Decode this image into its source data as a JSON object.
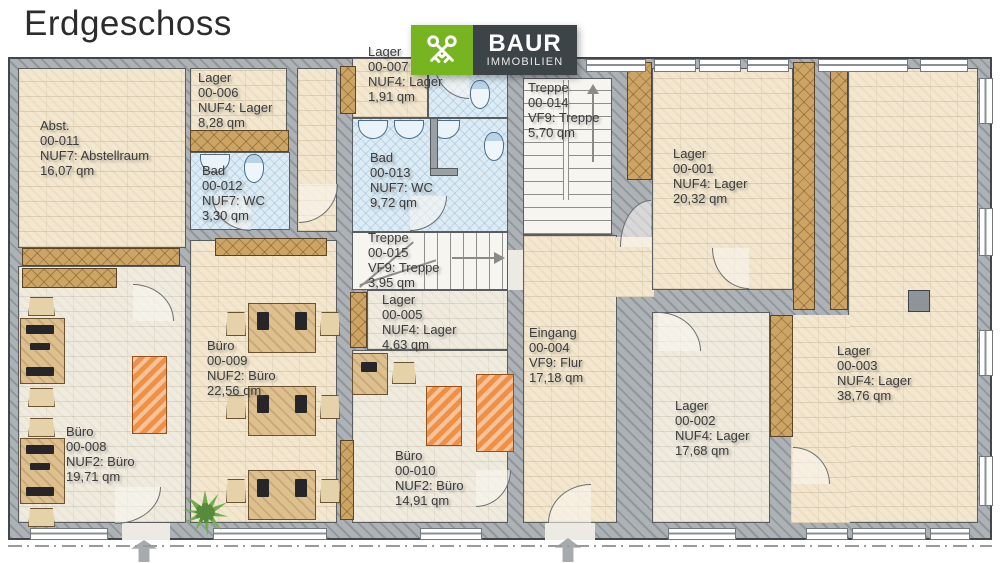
{
  "title": "Erdgeschoss",
  "logo": {
    "brand": "BAUR",
    "subtitle": "IMMOBILIEN",
    "green": "#77b520",
    "dark": "#3d4448",
    "icon": "crossed-keys"
  },
  "colors": {
    "wall": "#adb2b6",
    "floor_warm": "#f3e7cf",
    "floor_cool": "#f0ebdf",
    "bath_blue": "#dcebf4",
    "wood": "#cda463",
    "sofa_orange": "#ee9147",
    "plant_green": "#6fae4e",
    "label_text": "#3b3b3b"
  },
  "icons": {
    "logo": "crossed-keys-icon",
    "entrance": "arrow-up-icon",
    "plant": "plant-icon",
    "bath_fixtures": [
      "sink-icon",
      "toilet-icon"
    ]
  },
  "rooms": [
    {
      "name": "Abst.",
      "number": "00-011",
      "code": "NUF7: Abstellraum",
      "area": "16,07 qm"
    },
    {
      "name": "Lager",
      "number": "00-006",
      "code": "NUF4: Lager",
      "area": "8,28 qm"
    },
    {
      "name": "Bad",
      "number": "00-012",
      "code": "NUF7: WC",
      "area": "3,30 qm"
    },
    {
      "name": "Lager",
      "number": "00-007",
      "code": "NUF4: Lager",
      "area": "1,91 qm"
    },
    {
      "name": "Bad",
      "number": "00-013",
      "code": "NUF7: WC",
      "area": "9,72 qm"
    },
    {
      "name": "Treppe",
      "number": "00-014",
      "code": "VF9: Treppe",
      "area": "5,70 qm"
    },
    {
      "name": "Lager",
      "number": "00-001",
      "code": "NUF4: Lager",
      "area": "20,32 qm"
    },
    {
      "name": "Treppe",
      "number": "00-015",
      "code": "VF9: Treppe",
      "area": "3,95 qm"
    },
    {
      "name": "Lager",
      "number": "00-005",
      "code": "NUF4: Lager",
      "area": "4,63 qm"
    },
    {
      "name": "Büro",
      "number": "00-008",
      "code": "NUF2: Büro",
      "area": "19,71 qm"
    },
    {
      "name": "Büro",
      "number": "00-009",
      "code": "NUF2: Büro",
      "area": "22,56 qm"
    },
    {
      "name": "Büro",
      "number": "00-010",
      "code": "NUF2: Büro",
      "area": "14,91 qm"
    },
    {
      "name": "Eingang",
      "number": "00-004",
      "code": "VF9: Flur",
      "area": "17,18 qm"
    },
    {
      "name": "Lager",
      "number": "00-002",
      "code": "NUF4: Lager",
      "area": "17,68 qm"
    },
    {
      "name": "Lager",
      "number": "00-003",
      "code": "NUF4: Lager",
      "area": "38,76 qm"
    }
  ]
}
